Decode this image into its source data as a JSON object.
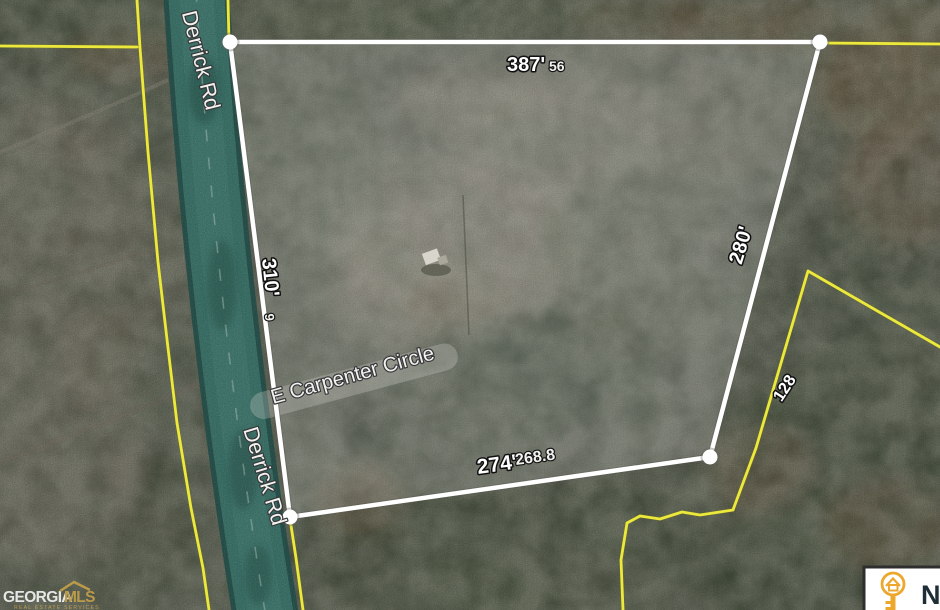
{
  "map": {
    "road_labels": {
      "derrick_upper": "Derrick Rd",
      "derrick_lower": "Derrick Rd",
      "carpenter": "E Carpenter Circle"
    },
    "dimensions": {
      "top": "387'",
      "top_alt": "56",
      "left": "310'",
      "left_alt": "9",
      "right": "280'",
      "right_lower": "128",
      "bottom": "274'",
      "bottom_alt": "268.8"
    },
    "watermark": {
      "brand_white": "GEORGIA",
      "brand_gold": "MLS",
      "tagline": "REAL ESTATE SERVICES"
    },
    "badge": {
      "text": "N"
    },
    "colors": {
      "parcel_line": "#ffffff",
      "boundary_yellow": "#ece93c",
      "road_teal": "#457f75",
      "brand_gold": "#c9a44a",
      "badge_gold": "#eca72c"
    }
  }
}
